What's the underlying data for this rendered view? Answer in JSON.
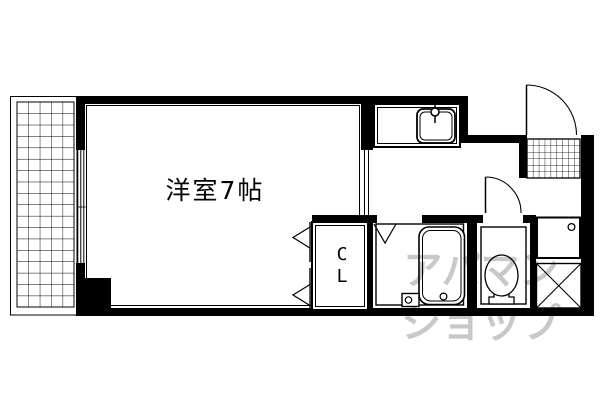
{
  "plan": {
    "room": {
      "label": "洋室7帖"
    },
    "closet": {
      "label_top": "C",
      "label_bottom": "L"
    },
    "watermark": {
      "line1": "アパマン",
      "line2": "ショップ"
    },
    "colors": {
      "ink": "#000000",
      "paper": "#ffffff",
      "watermark_gray": "#c8c8c8"
    },
    "icons": {
      "balcony": "balcony-grid-icon",
      "window": "sliding-window-icon",
      "kitchen_sink": "kitchen-sink-icon",
      "faucet": "faucet-icon",
      "entrance_door": "door-swing-icon",
      "entry_floor": "entry-tile-icon",
      "closet_doors": "bifold-door-icon",
      "bath_door": "folding-door-icon",
      "bathtub": "bathtub-icon",
      "drain_box": "drain-box-icon",
      "toilet": "toilet-icon",
      "toilet_door": "door-swing-icon",
      "washing_machine_pan": "washing-machine-pan-icon",
      "pipe_space": "pipe-space-x-icon"
    }
  }
}
